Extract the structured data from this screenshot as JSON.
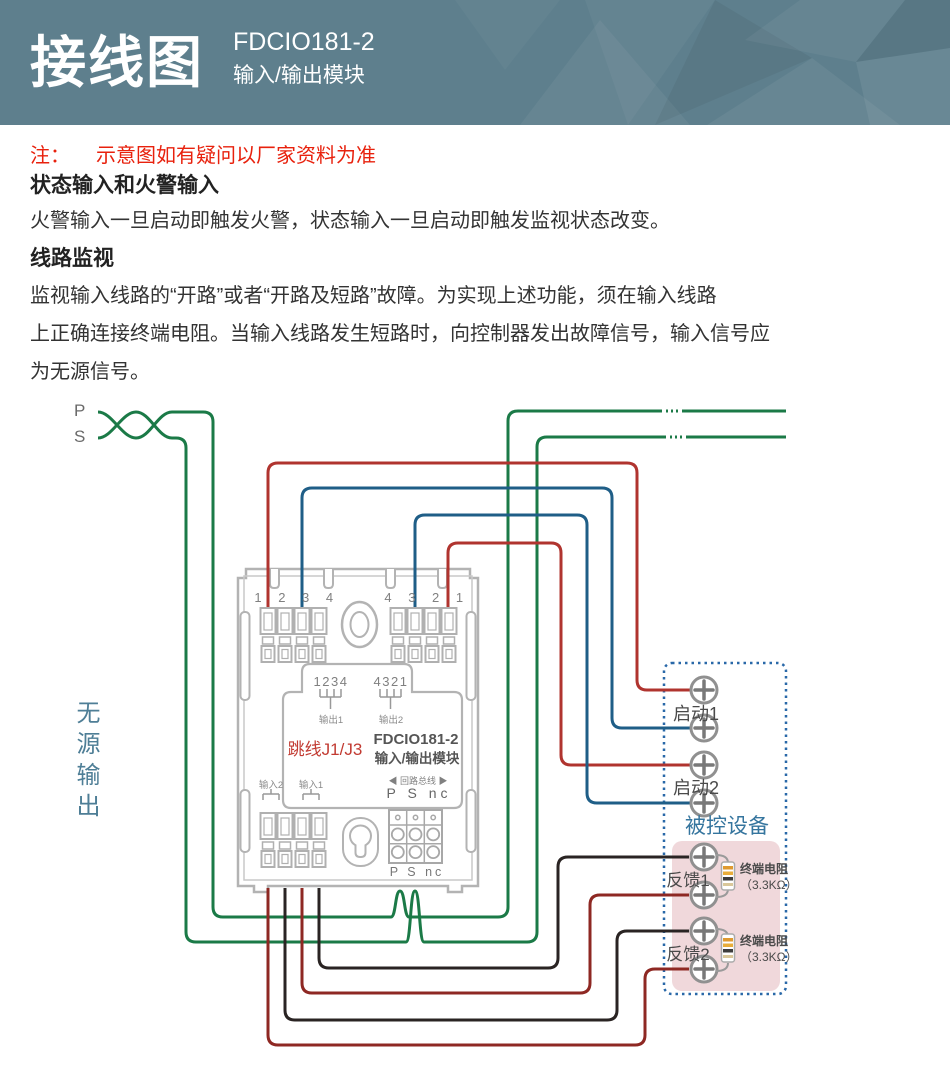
{
  "header": {
    "title": "接线图",
    "model": "FDCIO181-2",
    "subtitle": "输入/输出模块"
  },
  "notes": {
    "note_prefix": "注：",
    "note_text": "示意图如有疑问以厂家资料为准",
    "section1_title": "状态输入和火警输入",
    "section1_body": "火警输入一旦启动即触发火警，状态输入一旦启动即触发监视状态改变。",
    "section2_title": "线路监视",
    "section2_lines": [
      "监视输入线路的“开路”或者“开路及短路”故障。为实现上述功能，须在输入线路",
      "上正确连接终端电阻。当输入线路发生短路时，向控制器发出故障信号，输入信号应",
      "为无源信号。"
    ]
  },
  "diagram": {
    "loop_p": "P",
    "loop_s": "S",
    "passive_output": "无源输出",
    "module": {
      "top_left_terminals": "1 2 3 4",
      "top_right_terminals": "4 3 2 1",
      "jumper_pins_left": "1234",
      "jumper_pins_right": "4321",
      "output1": "输出1",
      "output2": "输出2",
      "jumper_label": "跳线J1/J3",
      "model": "FDCIO181-2",
      "model_sub": "输入/输出模块",
      "input2": "输入2",
      "input1": "输入1",
      "loop_bus": "◀ 回路总线 ▶",
      "loop_terminals": "P S nc",
      "grid_terminals": "P S nc"
    },
    "device": {
      "box_label": "被控设备",
      "start1": "启动1",
      "start2": "启动2",
      "feedback1": "反馈1",
      "feedback2": "反馈2",
      "terminal_resistor": "终端电阻",
      "resistor_value": "（3.3KΩ）"
    },
    "colors": {
      "loop_green": "#1b7a47",
      "control_red": "#b0342f",
      "control_blue": "#1f5e87",
      "feedback_dark_red": "#8e2823",
      "feedback_black": "#2a2423",
      "device_border_blue": "#2968a8",
      "device_fill_pink": "#f0d8db",
      "header_background": "#5e7f8d",
      "note_red": "#e8210d",
      "module_gray": "#b3b3b3"
    }
  }
}
